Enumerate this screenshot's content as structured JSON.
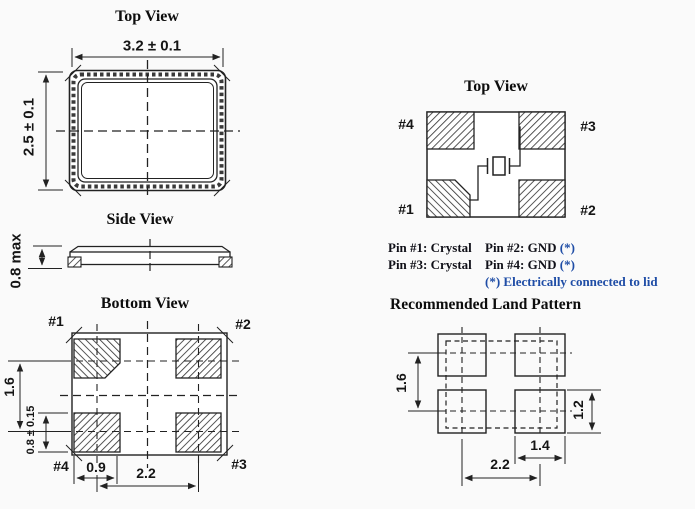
{
  "colors": {
    "line": "#222222",
    "accent_blue": "#1f4da6",
    "background": "#fafafa"
  },
  "package_top_view": {
    "title": "Top View",
    "width_dim": "3.2 ± 0.1",
    "height_dim": "2.5 ± 0.1"
  },
  "side_view": {
    "title": "Side View",
    "height_dim": "0.8 max"
  },
  "bottom_view": {
    "title": "Bottom View",
    "pin_labels": {
      "pin1": "#1",
      "pin2": "#2",
      "pin3": "#3",
      "pin4": "#4"
    },
    "dims": {
      "row_pitch": "1.6",
      "pad_height": "0.8 ± 0.15",
      "pad_width": "0.9",
      "col_pitch": "2.2"
    }
  },
  "pinout_top_view": {
    "title": "Top View",
    "pin_labels": {
      "pin1": "#1",
      "pin2": "#2",
      "pin3": "#3",
      "pin4": "#4"
    }
  },
  "pin_assignments": {
    "pin1": "Pin #1: Crystal",
    "pin3": "Pin #3: Crystal",
    "pin2": "Pin #2: GND",
    "pin4": "Pin #4: GND",
    "star": "(*)",
    "note": "(*) Electrically connected to lid"
  },
  "land_pattern": {
    "title": "Recommended Land Pattern",
    "dims": {
      "row_pitch": "1.6",
      "pad_height": "1.2",
      "pad_width": "1.4",
      "col_pitch": "2.2"
    }
  }
}
